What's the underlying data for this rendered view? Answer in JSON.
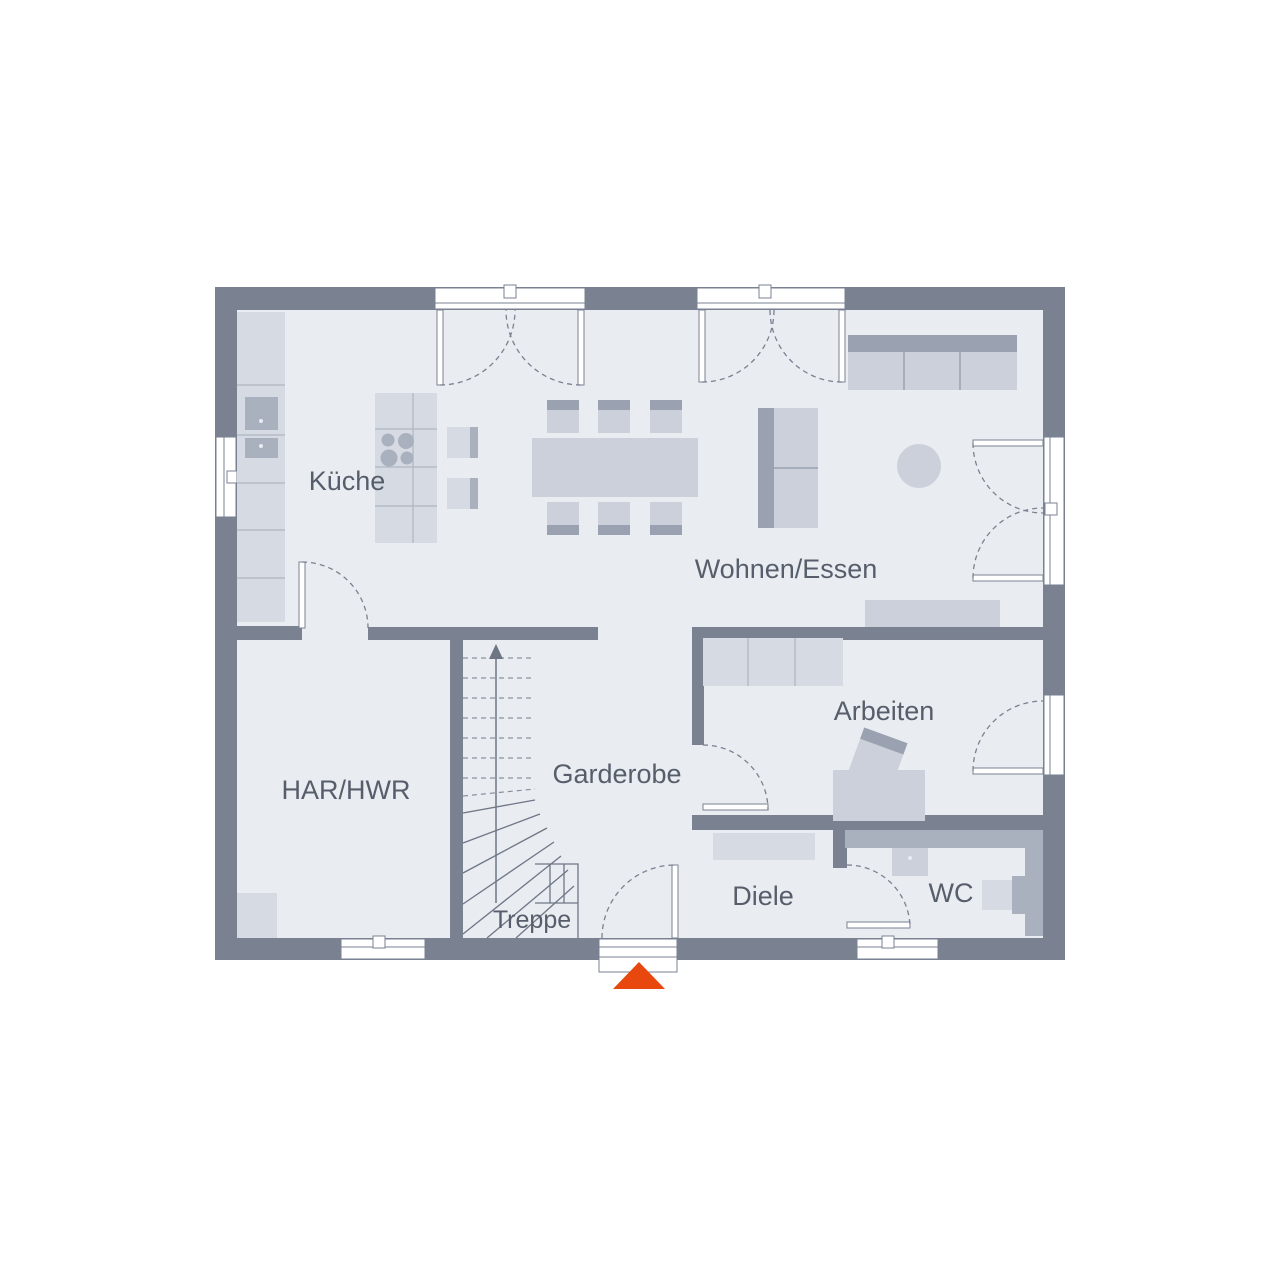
{
  "rooms": {
    "kueche": {
      "label": "Küche"
    },
    "wohnen_essen": {
      "label": "Wohnen/Essen"
    },
    "har_hwr": {
      "label": "HAR/HWR"
    },
    "garderobe": {
      "label": "Garderobe"
    },
    "treppe": {
      "label": "Treppe"
    },
    "diele": {
      "label": "Diele"
    },
    "wc": {
      "label": "WC"
    },
    "arbeiten": {
      "label": "Arbeiten"
    }
  },
  "colors": {
    "wall": "#7A8292",
    "floor": "#E9ECF1",
    "accent": "#E8470E",
    "label": "#575E6B",
    "line": "#7A8292",
    "furnLight": "#D6DAE2",
    "furnMid": "#CBD0DA",
    "furnDark": "#A9B0BE"
  }
}
